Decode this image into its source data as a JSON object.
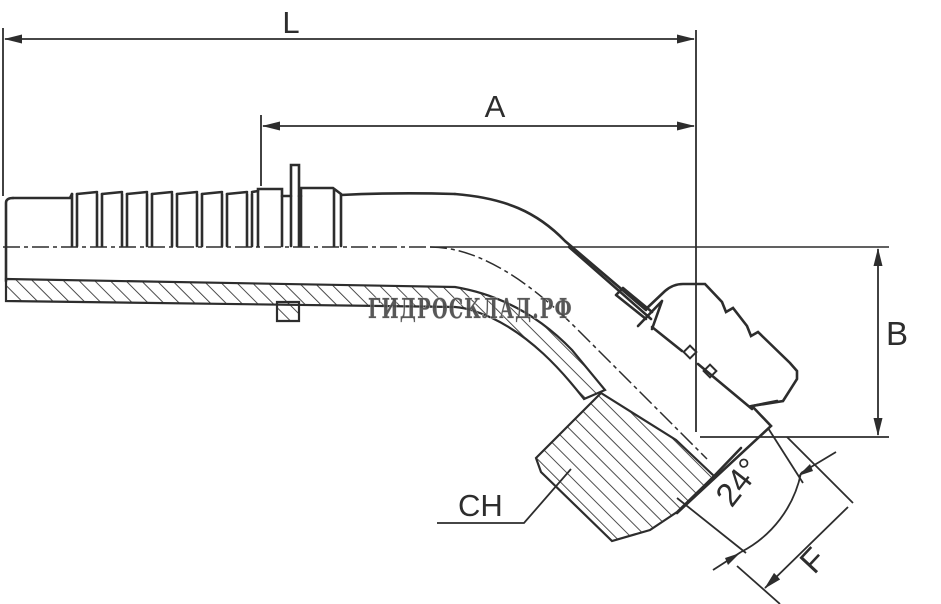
{
  "dims": {
    "L": "L",
    "A": "A",
    "B": "B",
    "CH": "CH",
    "F": "F",
    "cone_angle": "24°"
  },
  "watermark": {
    "text": "ГИДРОСКЛАД.РФ"
  },
  "colors": {
    "line": "#2d2d2d",
    "background": "#ffffff",
    "watermark_fill": "#4a4a4a",
    "watermark_outline": "#d9d9d9"
  }
}
